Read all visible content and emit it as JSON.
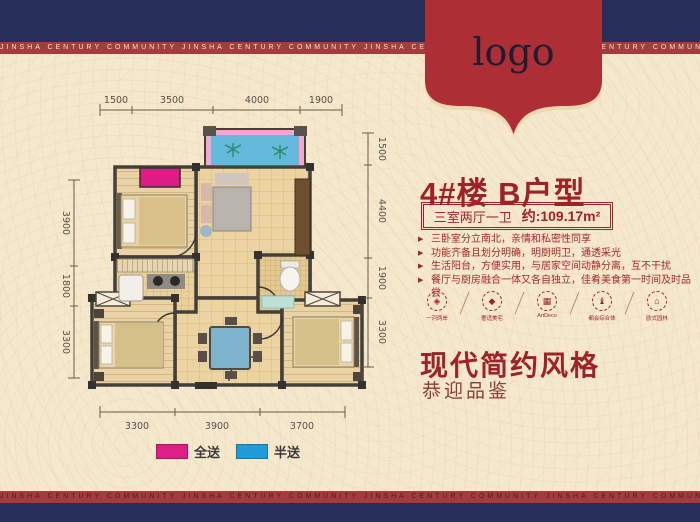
{
  "colors": {
    "background": "#f6e8cc",
    "navy_band": "#272e58",
    "red_strip": "#a43b3c",
    "ribbon_red": "#ae2e35",
    "accent_red": "#9e2227",
    "gift_full_magenta": "#dd1f85",
    "gift_half_blue": "#1f9cd8"
  },
  "ribbon": {
    "text": "JINSHA CENTURY COMMUNITY JINSHA CENTURY COMMUNITY JINSHA CENTURY COMMUNITY JINSHA CENTURY COMMUNITY JINSHA CENTURY COMMUNITY"
  },
  "logo": {
    "label": "logo"
  },
  "plan": {
    "dims_top": [
      "1500",
      "3500",
      "4000",
      "1900"
    ],
    "dims_left": [
      "3900",
      "1800",
      "3300"
    ],
    "dims_right": [
      "1500",
      "4400",
      "1900",
      "3300"
    ],
    "dims_bottom": [
      "3300",
      "3900",
      "3700"
    ],
    "legend": [
      {
        "label": "全送",
        "color": "#dd1f85"
      },
      {
        "label": "半送",
        "color": "#1f9cd8"
      }
    ]
  },
  "info": {
    "title": "4#楼  B户型",
    "spec": "三室两厅一卫",
    "area": "约:109.17m²",
    "bullets": [
      "三卧室分立南北，亲情和私密性同享",
      "功能齐备且划分明确，明厨明卫，通透采光",
      "生活阳台，方便实用，与居家空间动静分离，互不干扰",
      "餐厅与厨房融合一体又各自独立，佳肴美食第一时间及时品尝"
    ],
    "features": [
      {
        "label": "一河两岸",
        "glyph": "◈"
      },
      {
        "label": "奢适美宅",
        "glyph": "◆"
      },
      {
        "label": "ArtDeco",
        "glyph": "▦"
      },
      {
        "label": "都会综合体",
        "glyph": "♝"
      },
      {
        "label": "欧式园林",
        "glyph": "⌂"
      }
    ],
    "style_title": "现代简约风格",
    "style_sub": "恭迎品鉴"
  }
}
